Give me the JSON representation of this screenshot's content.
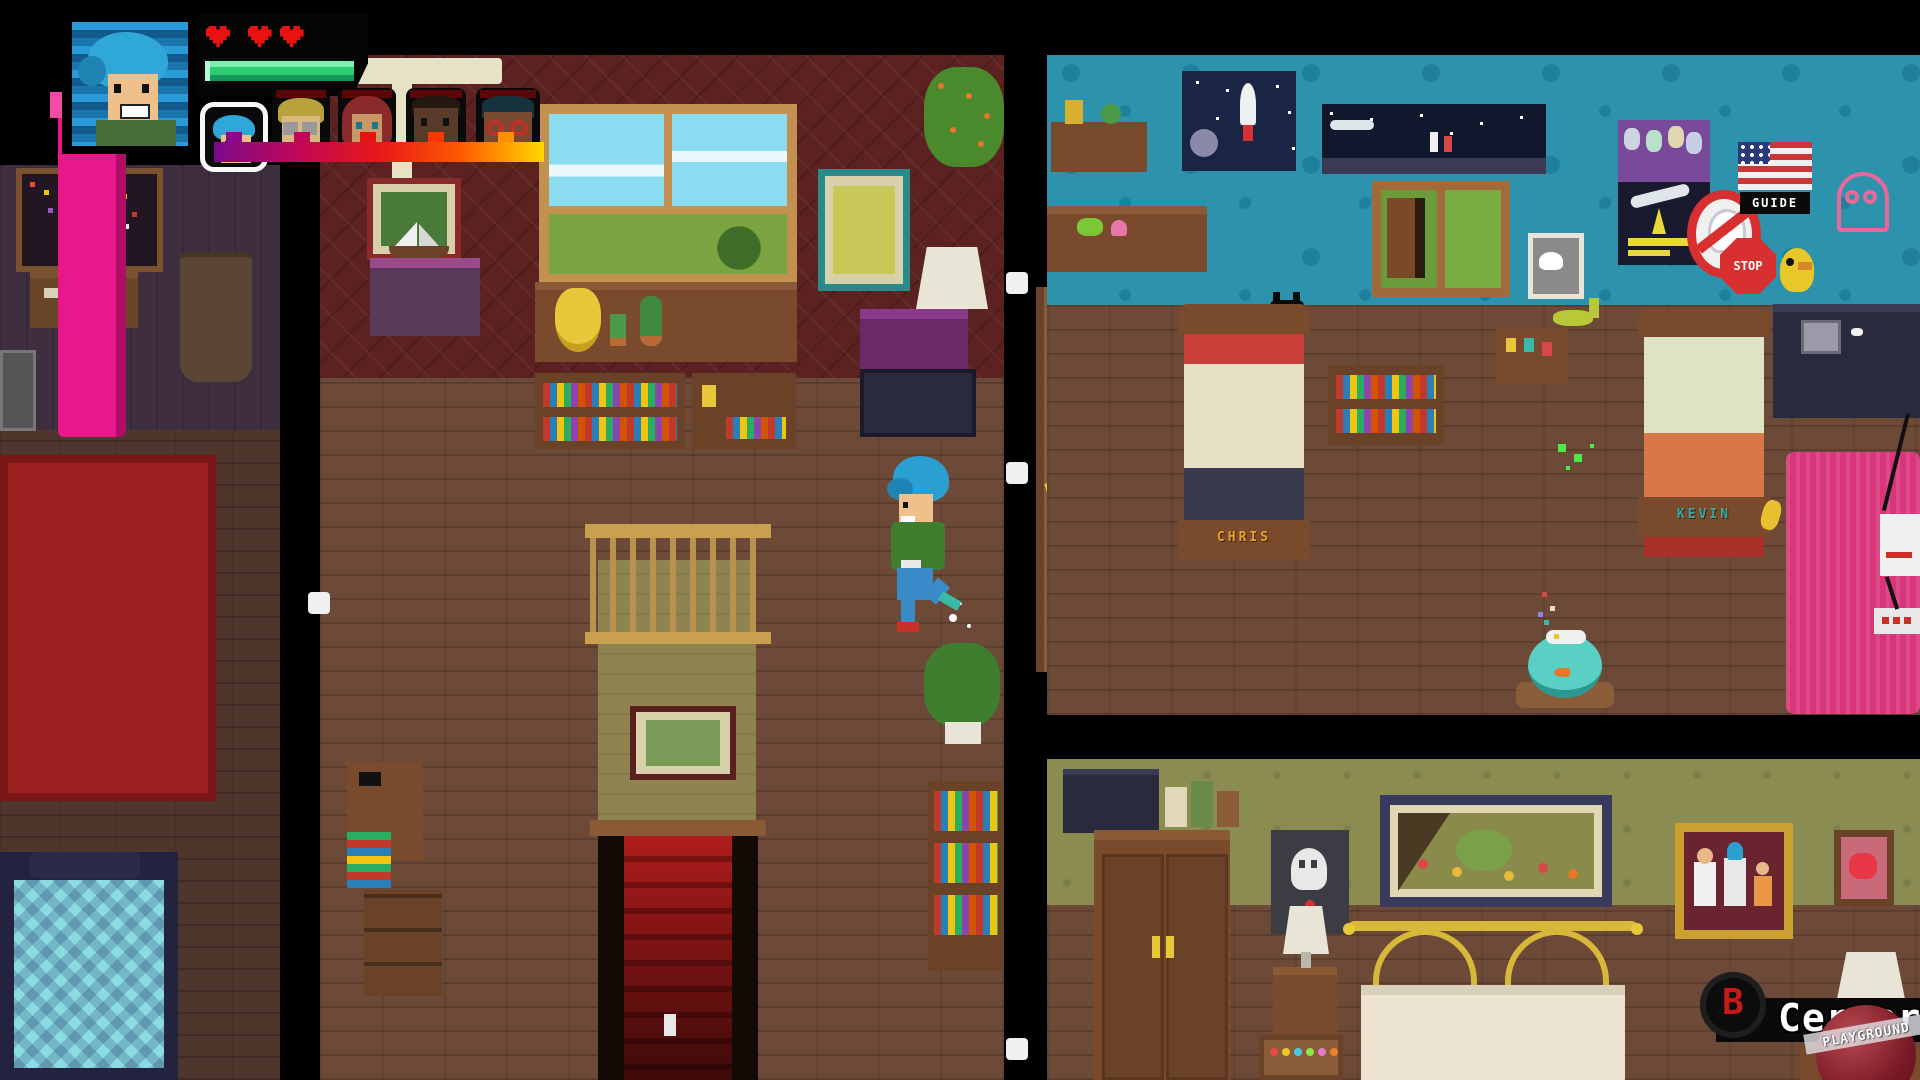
{
  "hud": {
    "hearts_count": 3,
    "heart_color": "#e81212",
    "health_percent": 100,
    "health_color": "#2ecc71",
    "party": [
      "blue-hair-selected",
      "blonde-glasses",
      "redhead-girl",
      "dark-skin-boy",
      "red-glasses-kid"
    ],
    "party_bar_gradient": [
      "#7a0a8a",
      "#c00858",
      "#e81818",
      "#ff5a00",
      "#ffd800"
    ]
  },
  "action_bar": {
    "key_label": "B",
    "key_color": "#c81818",
    "action_label": "Cerrar"
  },
  "watermark": {
    "text": "PLAYGROUND"
  },
  "scene": {
    "door_sticker_sign": "TOXIC",
    "stop_sign_label": "STOP",
    "flag_poster_label": "GUIDE",
    "left_bed_name": "CHRIS",
    "right_bed_name": "KEVIN",
    "pink_bed_color": "#d8357a",
    "kids_wall_color": "#2d93ac",
    "stairs_carpet_color": "#b01c1c"
  }
}
